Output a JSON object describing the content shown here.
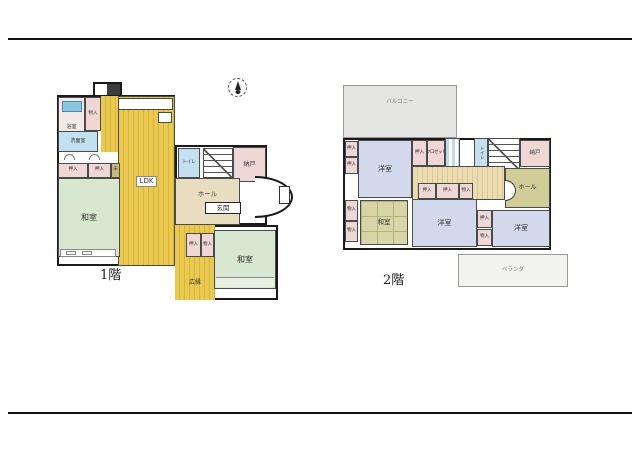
{
  "page": {
    "floor1_caption": "1階",
    "floor2_caption": "2階"
  },
  "compass": {
    "icon": "north-arrow"
  },
  "colors": {
    "wood_floor": "#e6c24a",
    "tatami_green": "#d7e7d0",
    "tatami_olive": "#d8d5a6",
    "closet_pink": "#eed7d4",
    "water_blue": "#c2e0f0",
    "hall_beige": "#e9ddc1",
    "western_lavender": "#d3d9ec",
    "balcony_gray": "#e4e4e3",
    "wall": "#1a1a1a"
  },
  "floor1": {
    "caption": "1階",
    "rooms": {
      "bath": "浴室",
      "mono_top": "物入",
      "washroom": "洗面室",
      "oshiire_a": "押入",
      "oshiire_b": "押入",
      "toko": "床",
      "washitsu_a": "和室",
      "ldk": "LDK",
      "toilet": "トイレ",
      "nando": "納戸",
      "hall": "ホール",
      "genkan": "玄関",
      "oshiire_c": "押入",
      "mono_c": "物入",
      "hiroen": "広縁",
      "washitsu_b": "和室"
    }
  },
  "floor2": {
    "caption": "2階",
    "balcony_top": "バルコニー",
    "veranda_bottom": "ベランダ",
    "rooms": {
      "yoshitsu_a": "洋室",
      "oshiire_w1": "押入",
      "oshiire_w2": "押入",
      "mono_w1": "物入",
      "mono_w2": "物入",
      "oshiire_top": "押入",
      "closet_top": "クロゼット",
      "toilet": "トイレ",
      "nando_ne": "納戸",
      "hall": "ホール",
      "oshiire_m1": "押入",
      "oshiire_m2": "押入",
      "mono_m": "物入",
      "washitsu": "和室",
      "yoshitsu_b": "洋室",
      "oshiire_e": "押入",
      "mono_e": "物入",
      "yoshitsu_c": "洋室"
    }
  }
}
